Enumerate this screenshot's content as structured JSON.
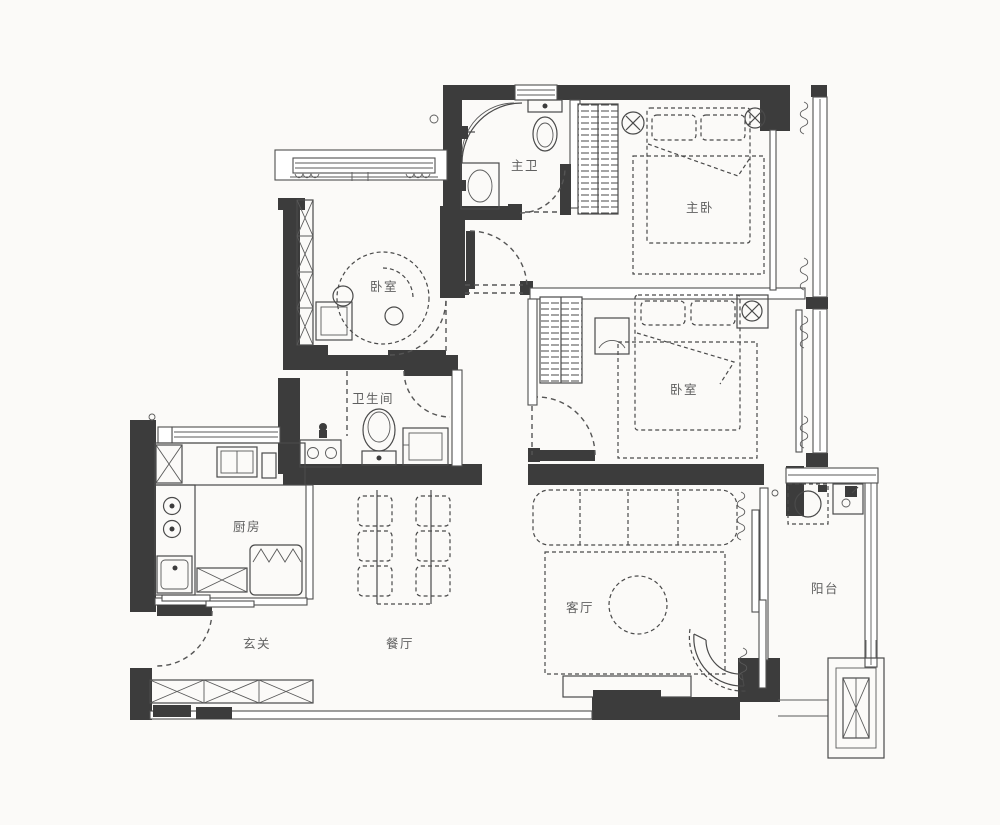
{
  "palette": {
    "wall": "#3c3c3c",
    "line": "#4a4a4a",
    "label": "#5f5f5f",
    "background": "#fbfaf8"
  },
  "rooms": {
    "master_bath": {
      "label": "主卫"
    },
    "master_bedroom": {
      "label": "主卧"
    },
    "bedroom_left": {
      "label": "卧室"
    },
    "bathroom": {
      "label": "卫生间"
    },
    "bedroom_right": {
      "label": "卧室"
    },
    "kitchen": {
      "label": "厨房"
    },
    "entry": {
      "label": "玄关"
    },
    "dining": {
      "label": "餐厅"
    },
    "living": {
      "label": "客厅"
    },
    "balcony": {
      "label": "阳台"
    }
  }
}
